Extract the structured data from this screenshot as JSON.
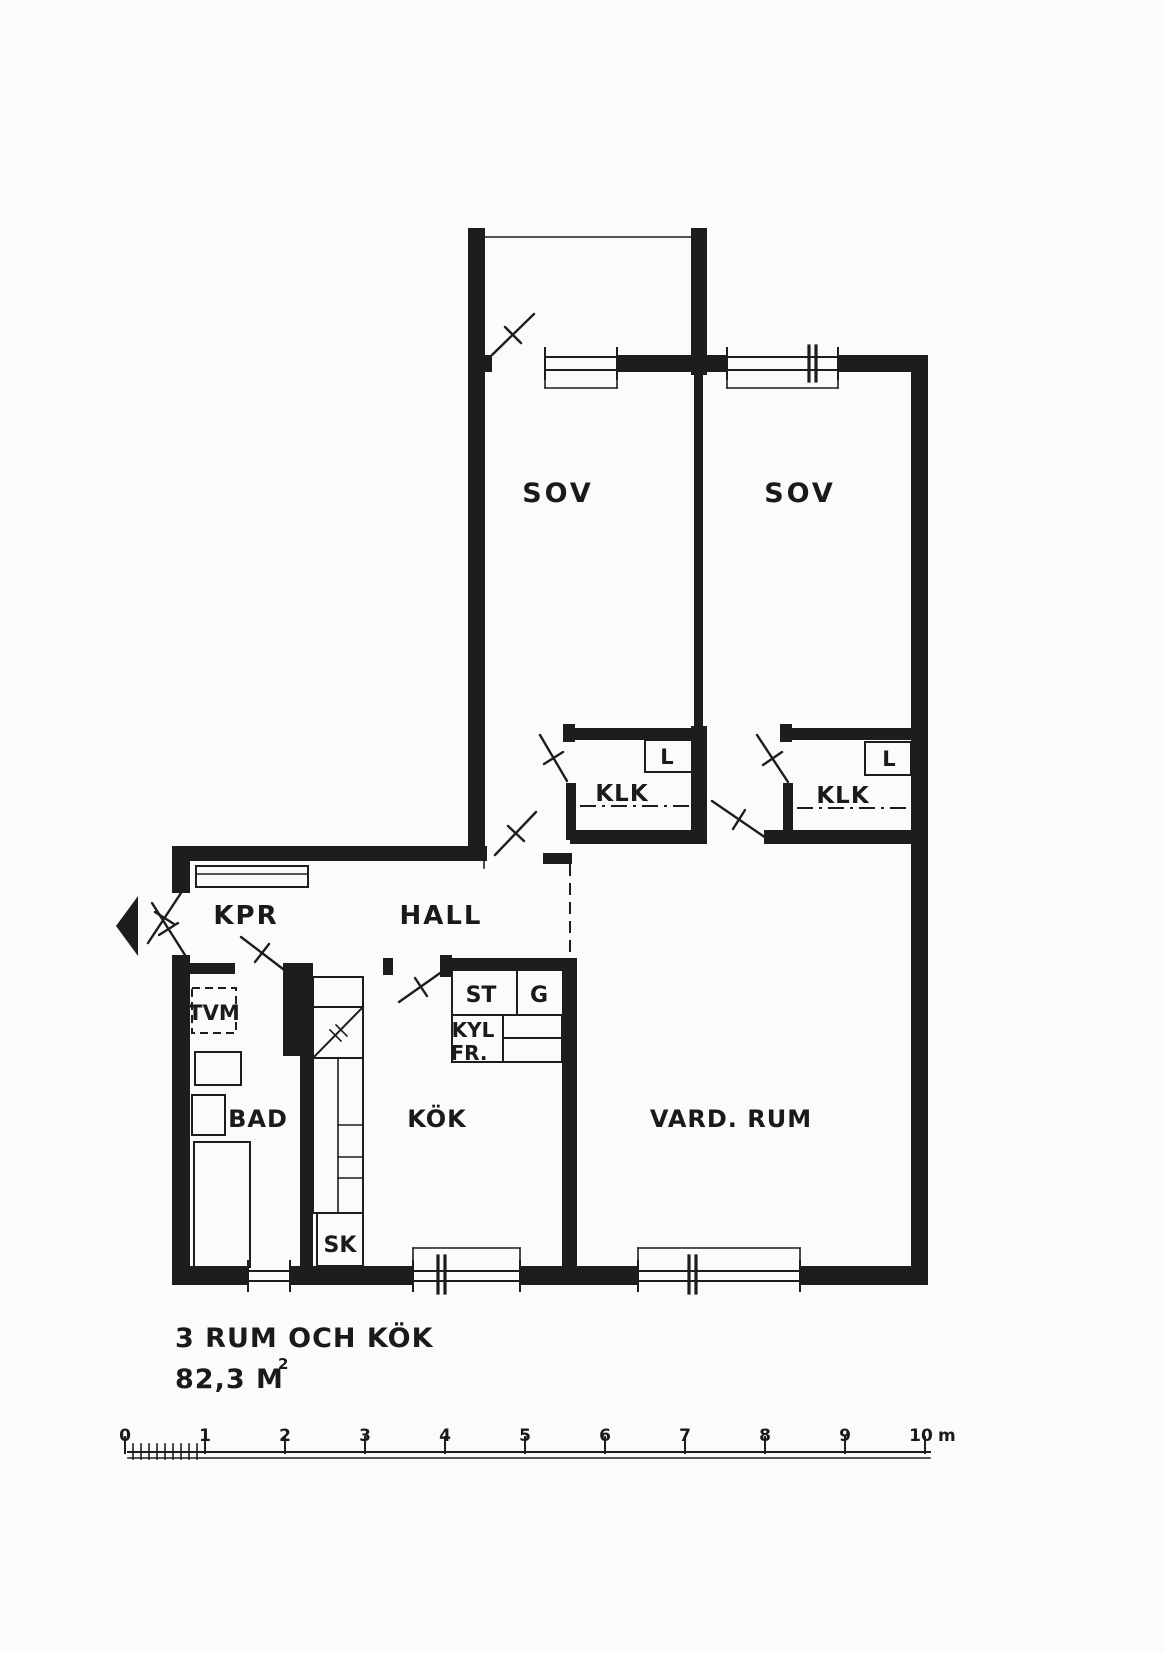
{
  "colors": {
    "ink": "#1d1d1d",
    "paper": "#fbfbfa"
  },
  "rooms": {
    "sov1": "SOV",
    "sov2": "SOV",
    "klk1": "KLK",
    "klk2": "KLK",
    "kpr": "KPR",
    "hall": "HALL",
    "bad": "BAD",
    "kok": "KÖK",
    "vardagsrum": "VARD. RUM"
  },
  "fixtures": {
    "l1": "L",
    "l2": "L",
    "tvm": "TVM",
    "st": "ST",
    "g": "G",
    "kyl": "KYL",
    "fr": "FR.",
    "sk": "SK"
  },
  "footer": {
    "title": "3 RUM OCH KÖK",
    "area": "82,3 M",
    "area_sup": "2"
  },
  "scale_bar": {
    "labels": [
      "0",
      "1",
      "2",
      "3",
      "4",
      "5",
      "6",
      "7",
      "8",
      "9",
      "10"
    ],
    "unit": "m"
  }
}
